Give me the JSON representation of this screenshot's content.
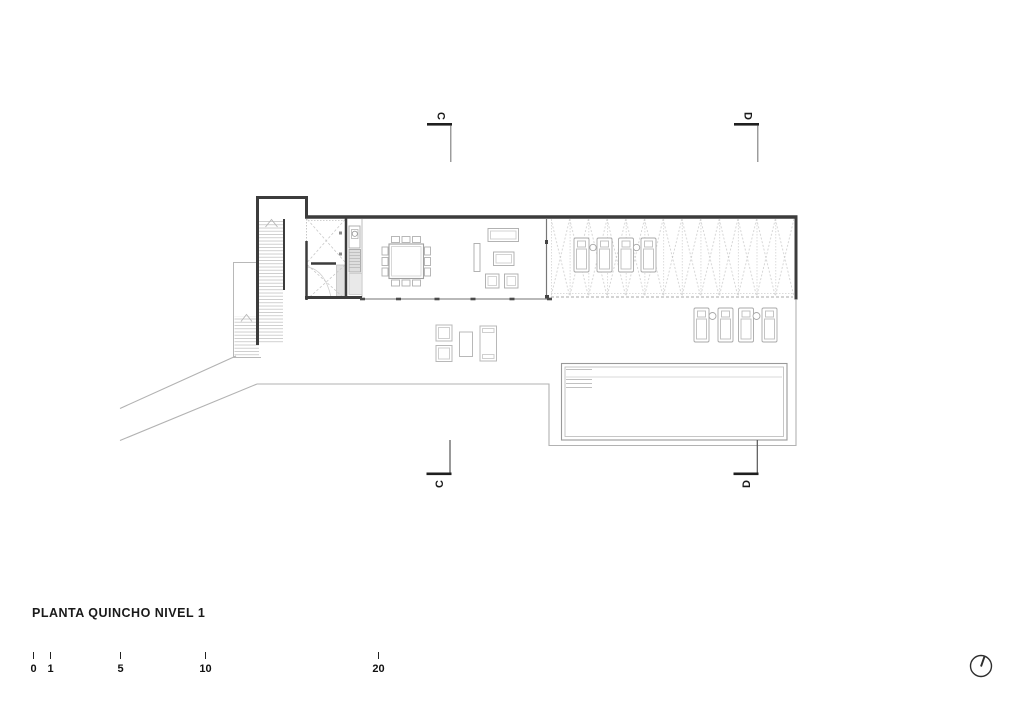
{
  "title": "PLANTA QUINCHO NIVEL 1",
  "section_markers": {
    "top": [
      {
        "letter": "C"
      },
      {
        "letter": "D"
      }
    ],
    "bottom": [
      {
        "letter": "C"
      },
      {
        "letter": "D"
      }
    ]
  },
  "scale_bar": {
    "unit_labels": [
      "0",
      "1",
      "5",
      "10",
      "20"
    ]
  },
  "icons": {
    "north_indicator": "north-clock-icon",
    "stair_direction": "up-arrow-chevron"
  },
  "colors": {
    "background": "#ffffff",
    "wall": "#3c3c3c",
    "medium_line": "#8f8f8f",
    "light_line": "#b8b8b8",
    "lattice": "#cdcdcd",
    "text": "#1a1a1a"
  },
  "drawing": {
    "type": "architectural-floor-plan",
    "depicted_elements": [
      "main-stair",
      "exterior-stair",
      "entry-ramp",
      "vestibule",
      "bathroom-with-tile-hatch",
      "grill-counter-strip",
      "dining-table-12-chairs",
      "sofa",
      "coffee-table",
      "armchairs",
      "sideboard",
      "pergola-lattice-roof",
      "sun-loungers-pergola",
      "sun-loungers-pool",
      "terrace",
      "terrace-furniture",
      "swimming-pool-with-steps"
    ]
  }
}
